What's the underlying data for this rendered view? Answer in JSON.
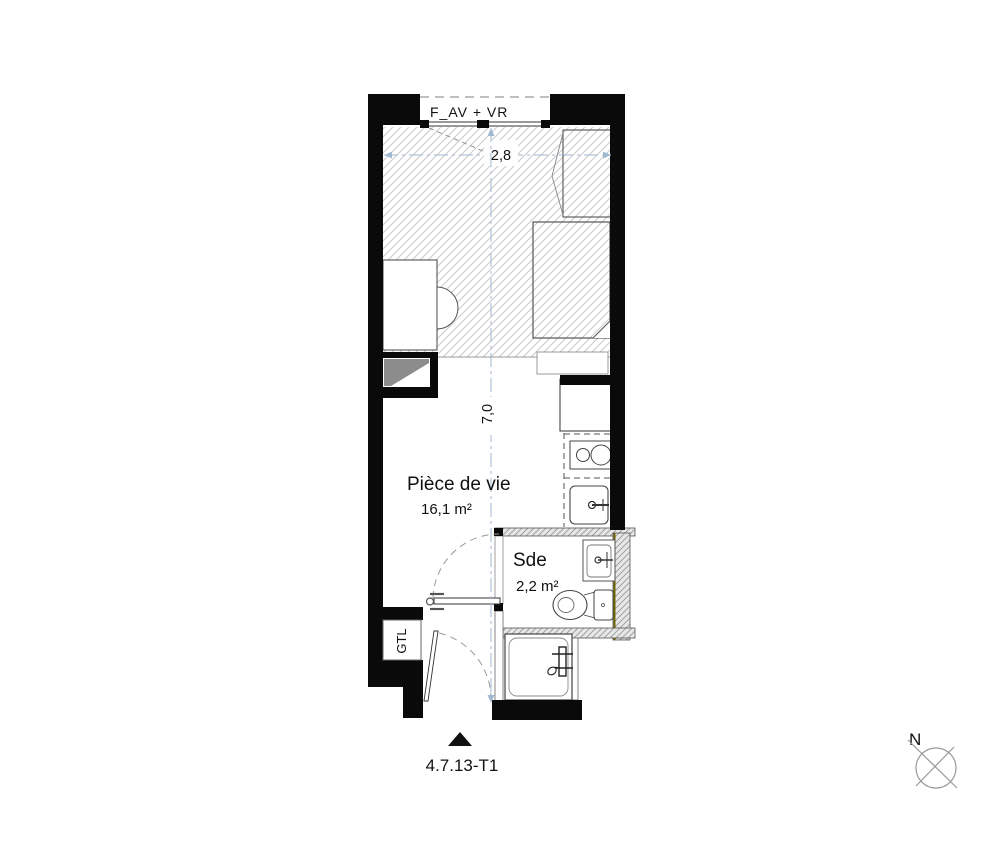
{
  "plan": {
    "reference": "4.7.13-T1",
    "north_label": "N",
    "window_label": "F_AV + VR",
    "dimensions": {
      "width_m": "2,8",
      "depth_m": "7,0"
    },
    "rooms": [
      {
        "name": "Pièce de vie",
        "area": "16,1 m²"
      },
      {
        "name": "Sde",
        "area": "2,2 m²"
      }
    ],
    "technical": {
      "gtl_label": "GTL"
    },
    "fixtures": [
      "wardrobe",
      "bed",
      "bench",
      "desk",
      "chair",
      "fridge-counter",
      "cooktop",
      "kitchen-sink",
      "washbasin",
      "toilet",
      "shower",
      "entry-door",
      "sde-door",
      "window-roller-shutter"
    ]
  },
  "colors": {
    "wall_black": "#0a0a0a",
    "hatch_line": "#c9c9c9",
    "thin_line": "#444444",
    "furniture_line": "#555555",
    "light_line": "#999999",
    "partition_fill": "#e7e7e7",
    "partition_hatch": "#9a9a9a",
    "accent_olive": "#6f6400",
    "dimension_blue": "#9fb9d0",
    "shaft_shade": "#8c8c8c",
    "background": "#ffffff"
  }
}
